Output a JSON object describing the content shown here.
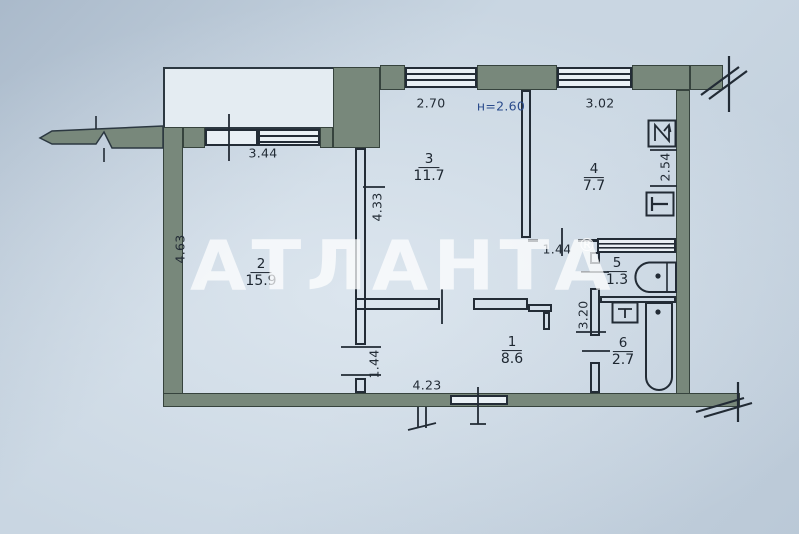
{
  "watermark": {
    "text": "Атланта",
    "reg": "®"
  },
  "plan": {
    "height_note": "н=2.60",
    "rooms": [
      {
        "number": "1",
        "area": "8.6"
      },
      {
        "number": "2",
        "area": "15.9"
      },
      {
        "number": "3",
        "area": "11.7"
      },
      {
        "number": "4",
        "area": "7.7"
      },
      {
        "number": "5",
        "area": "1.3"
      },
      {
        "number": "6",
        "area": "2.7"
      }
    ],
    "dimensions": {
      "room2_width": "3.44",
      "room2_depth": "4.63",
      "room3_width": "2.70",
      "room3_depth": "4.33",
      "room4_width": "3.02",
      "room4_depth": "2.54",
      "kitchen_door_width": "1.44",
      "room1_door_width": "1.44",
      "room1_width": "4.23",
      "bathroom_block_depth": "3.20"
    },
    "icons": [
      "fridge-icon",
      "stove-icon",
      "toilet-icon",
      "washbasin-icon",
      "bathtub-icon"
    ],
    "colors": {
      "wall": "#78887b",
      "ink": "#232c36",
      "paper": "#c9d6e2",
      "height_note_ink": "#2a4b8c",
      "watermark": "#ffffff"
    }
  }
}
